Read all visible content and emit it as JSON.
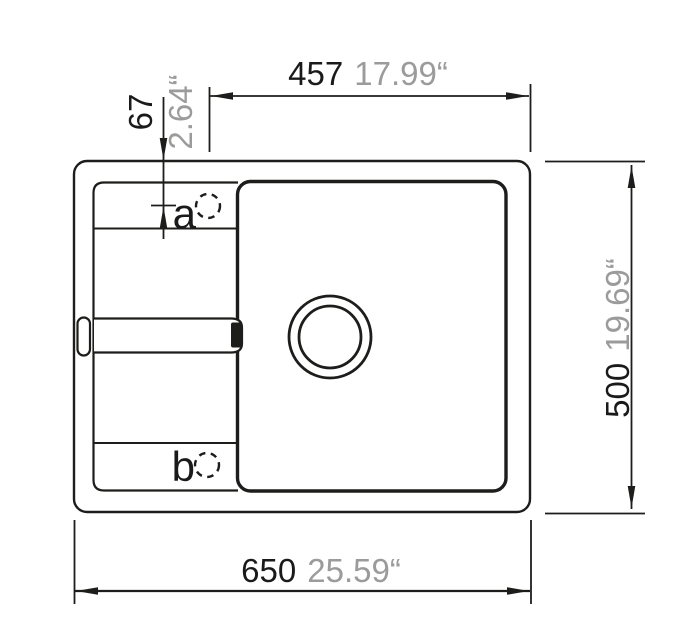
{
  "colors": {
    "line": "#1d1d1b",
    "dim_mm_text": "#1a1a1a",
    "dim_inch_text": "#9b9b9b",
    "background": "#ffffff"
  },
  "dimensions": {
    "top_width": {
      "mm": "457",
      "inch": "17.99“"
    },
    "hole_a_offset": {
      "mm": "67",
      "inch": "2.64“"
    },
    "height": {
      "mm": "500",
      "inch": "19.69“"
    },
    "bottom_width": {
      "mm": "650",
      "inch": "25.59“"
    }
  },
  "labels": {
    "hole_a": "a",
    "hole_b": "b"
  }
}
